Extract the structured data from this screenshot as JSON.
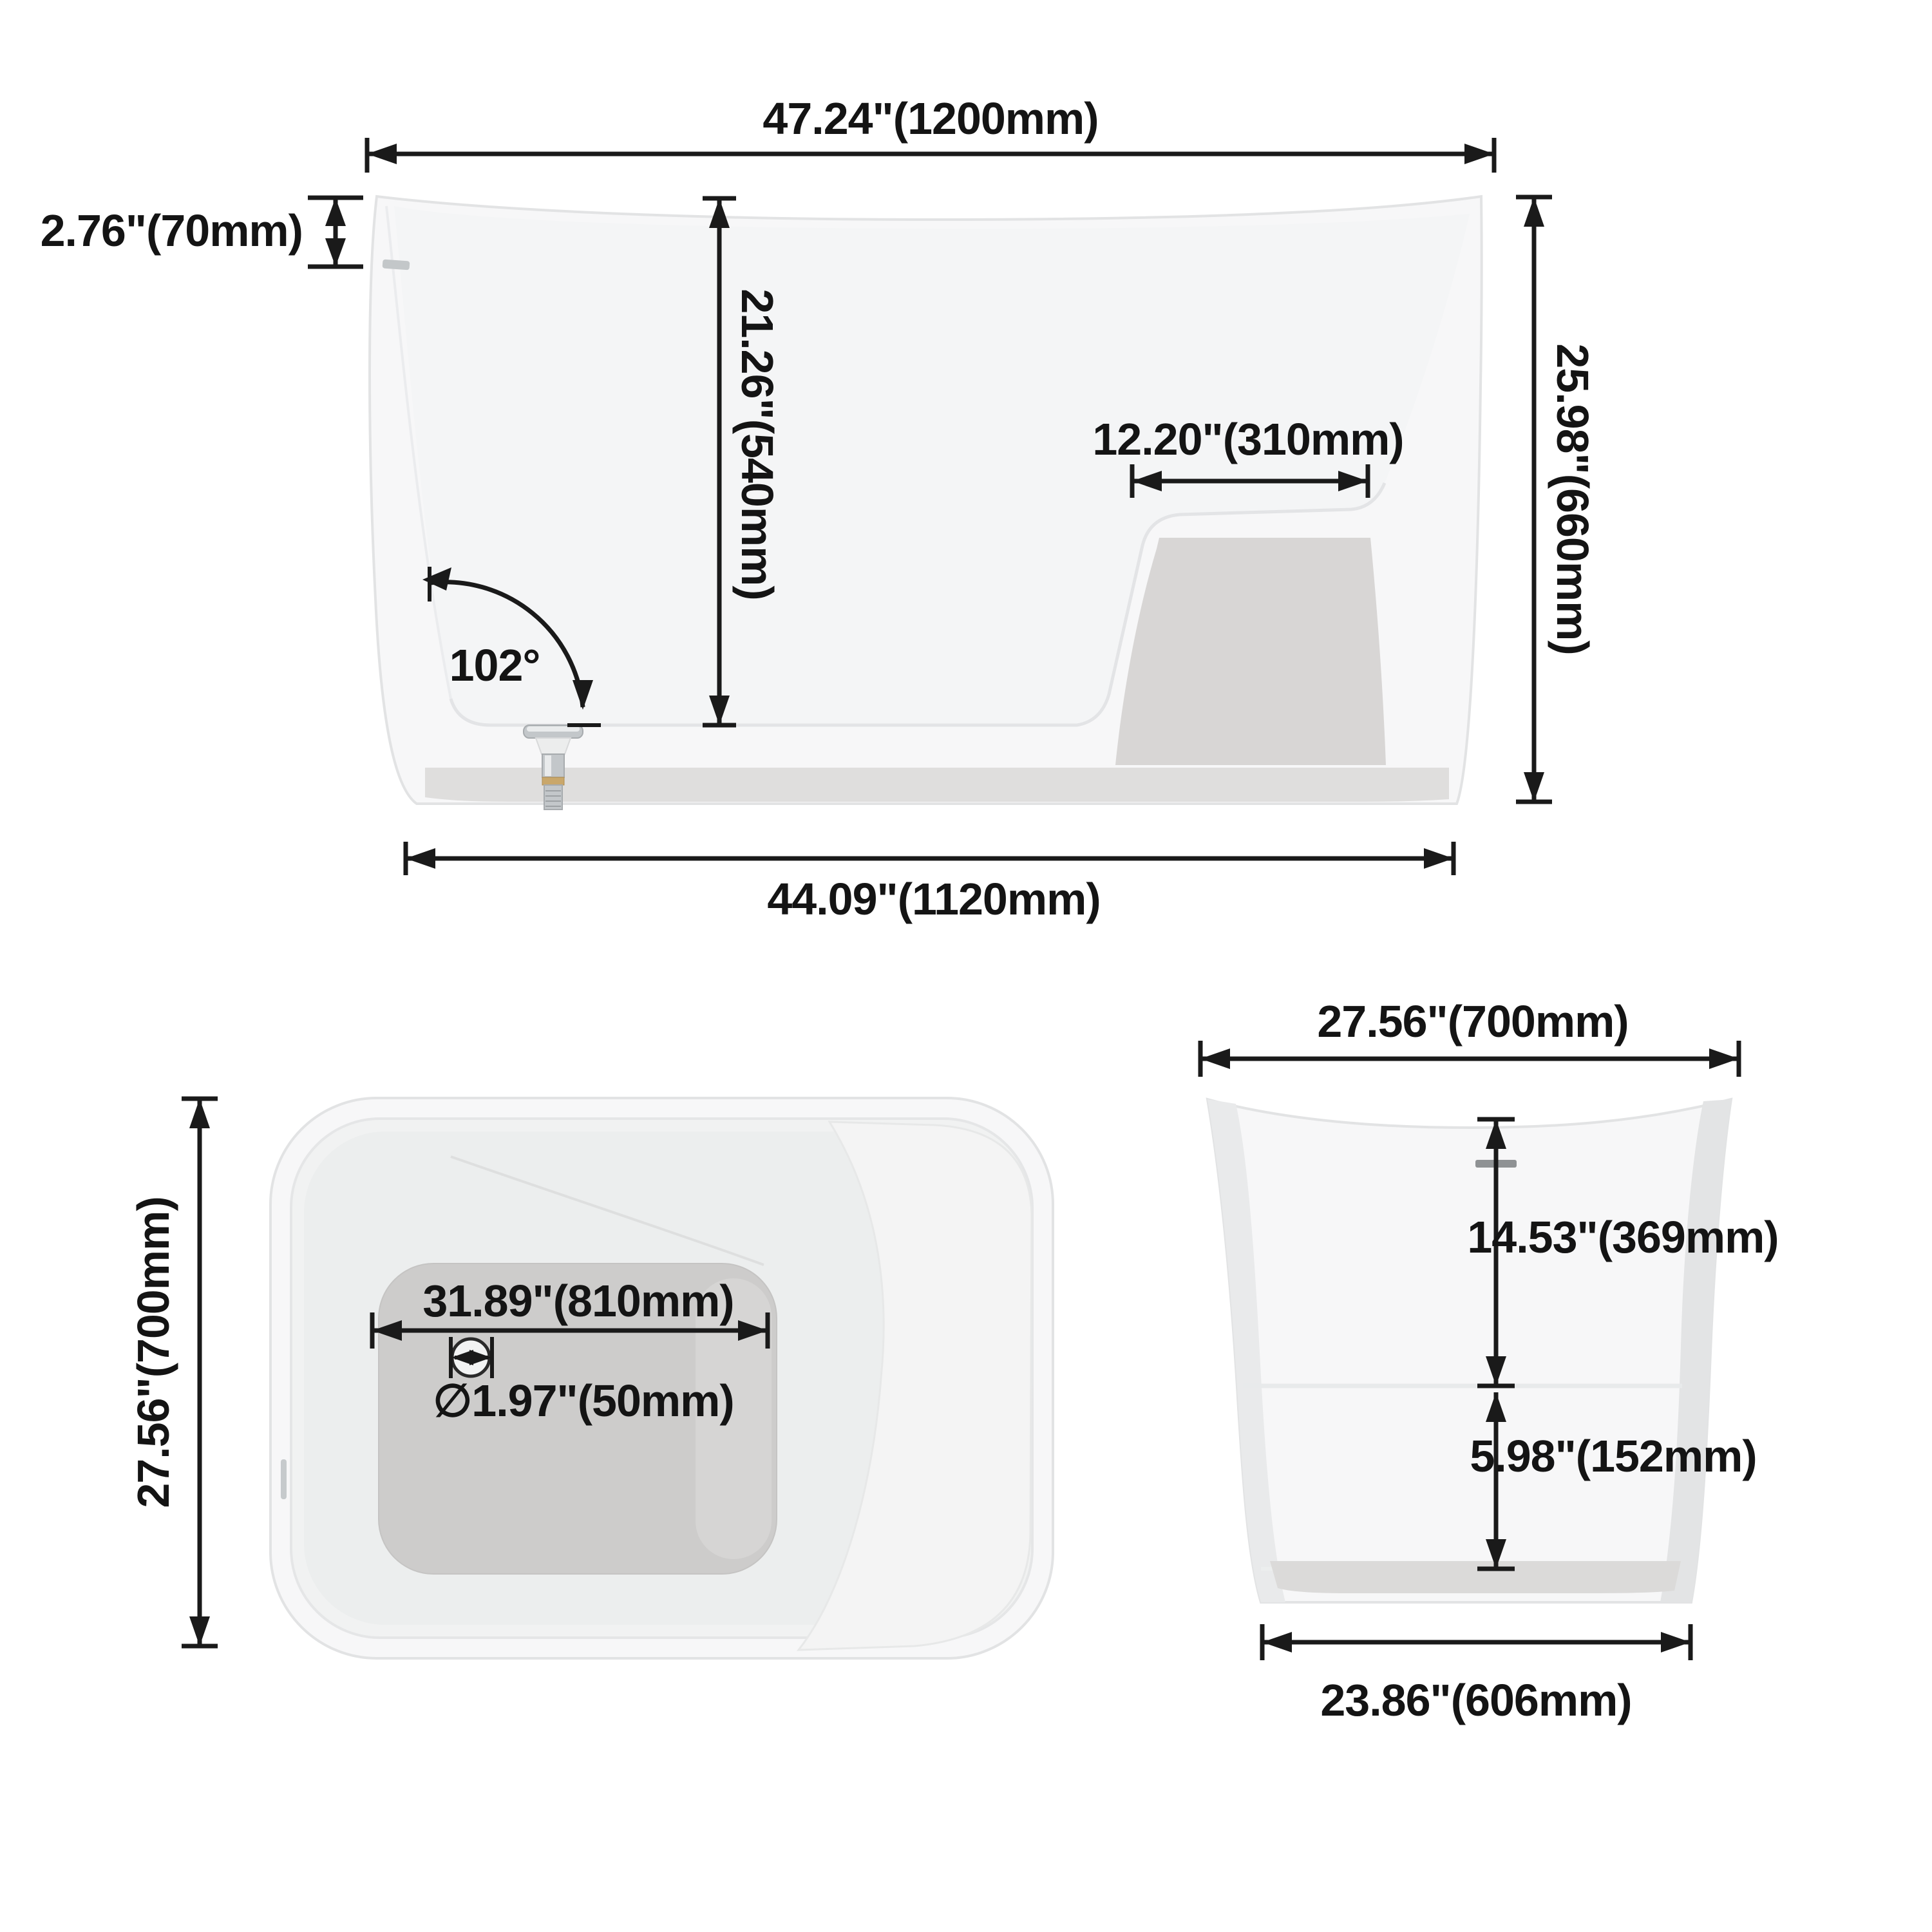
{
  "drawing": {
    "type": "bathtub-dimension-diagram",
    "views": [
      "side-profile",
      "plan-top",
      "end-elevation"
    ]
  },
  "views": {
    "side": {
      "dims": {
        "top_width": "47.24\"(1200mm)",
        "rim_height": "2.76\"(70mm)",
        "inner_depth": "21.26\"(540mm)",
        "seat_depth": "12.20\"(310mm)",
        "wall_angle": "102°",
        "overall_height": "25.98\"(660mm)",
        "bottom_width": "44.09\"(1120mm)"
      }
    },
    "plan": {
      "dims": {
        "overall_length": "27.56\"(700mm)",
        "floor_length": "31.89\"(810mm)",
        "drain_diameter": "∅1.97\"(50mm)"
      }
    },
    "end": {
      "dims": {
        "top_width": "27.56\"(700mm)",
        "rim_to_seat": "14.53\"(369mm)",
        "seat_to_floor": "5.98\"(152mm)",
        "bottom_width": "23.86\"(606mm)"
      }
    }
  },
  "colors": {
    "ink": "#1a1a1a",
    "outline": "#e2e3e4",
    "shadow": "#d8d6d5",
    "plinth": "#dfdedd",
    "floor": "#cdcccb",
    "chrome": "#c3c7ca",
    "brass": "#c9a76b",
    "overflow_mark": "#8f9294"
  }
}
